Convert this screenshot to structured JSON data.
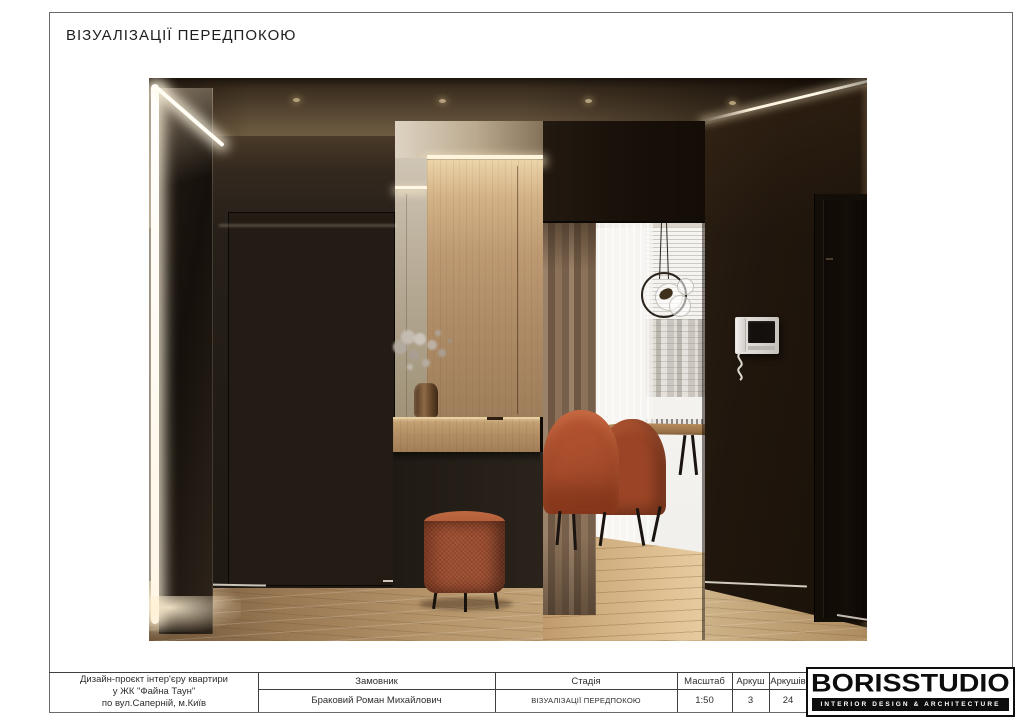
{
  "page": {
    "title": "ВІЗУАЛІЗАЦІЇ ПЕРЕДПОКОЮ"
  },
  "title_block": {
    "project": {
      "line1": "Дизайн-проєкт інтер'єру квартири",
      "line2": "у ЖК \"Файна Таун\"",
      "line3": "по вул.Саперній, м.Київ"
    },
    "columns": [
      {
        "header": "Замовник",
        "value": "Браковий Роман Михайлович"
      },
      {
        "header": "Стадія",
        "value": "ВІЗУАЛІЗАЦІЇ ПЕРЕДПОКОЮ"
      },
      {
        "header": "Масштаб",
        "value": "1:50"
      },
      {
        "header": "Аркуш",
        "value": "3"
      },
      {
        "header": "Аркушів",
        "value": "24"
      }
    ],
    "logo": {
      "name": "BORISSTUDIO",
      "tagline": "INTERIOR DESIGN & ARCHITECTURE"
    }
  },
  "render": {
    "colors": {
      "accent_terracotta": "#A85432",
      "wood_panel": "#B2906C",
      "dark_wall": "#221C16",
      "floor_oak": "#C2A174",
      "ceiling_bronze": "#86715C",
      "led_light": "#FFF4DE",
      "curtain_taupe": "#8A7158"
    }
  }
}
